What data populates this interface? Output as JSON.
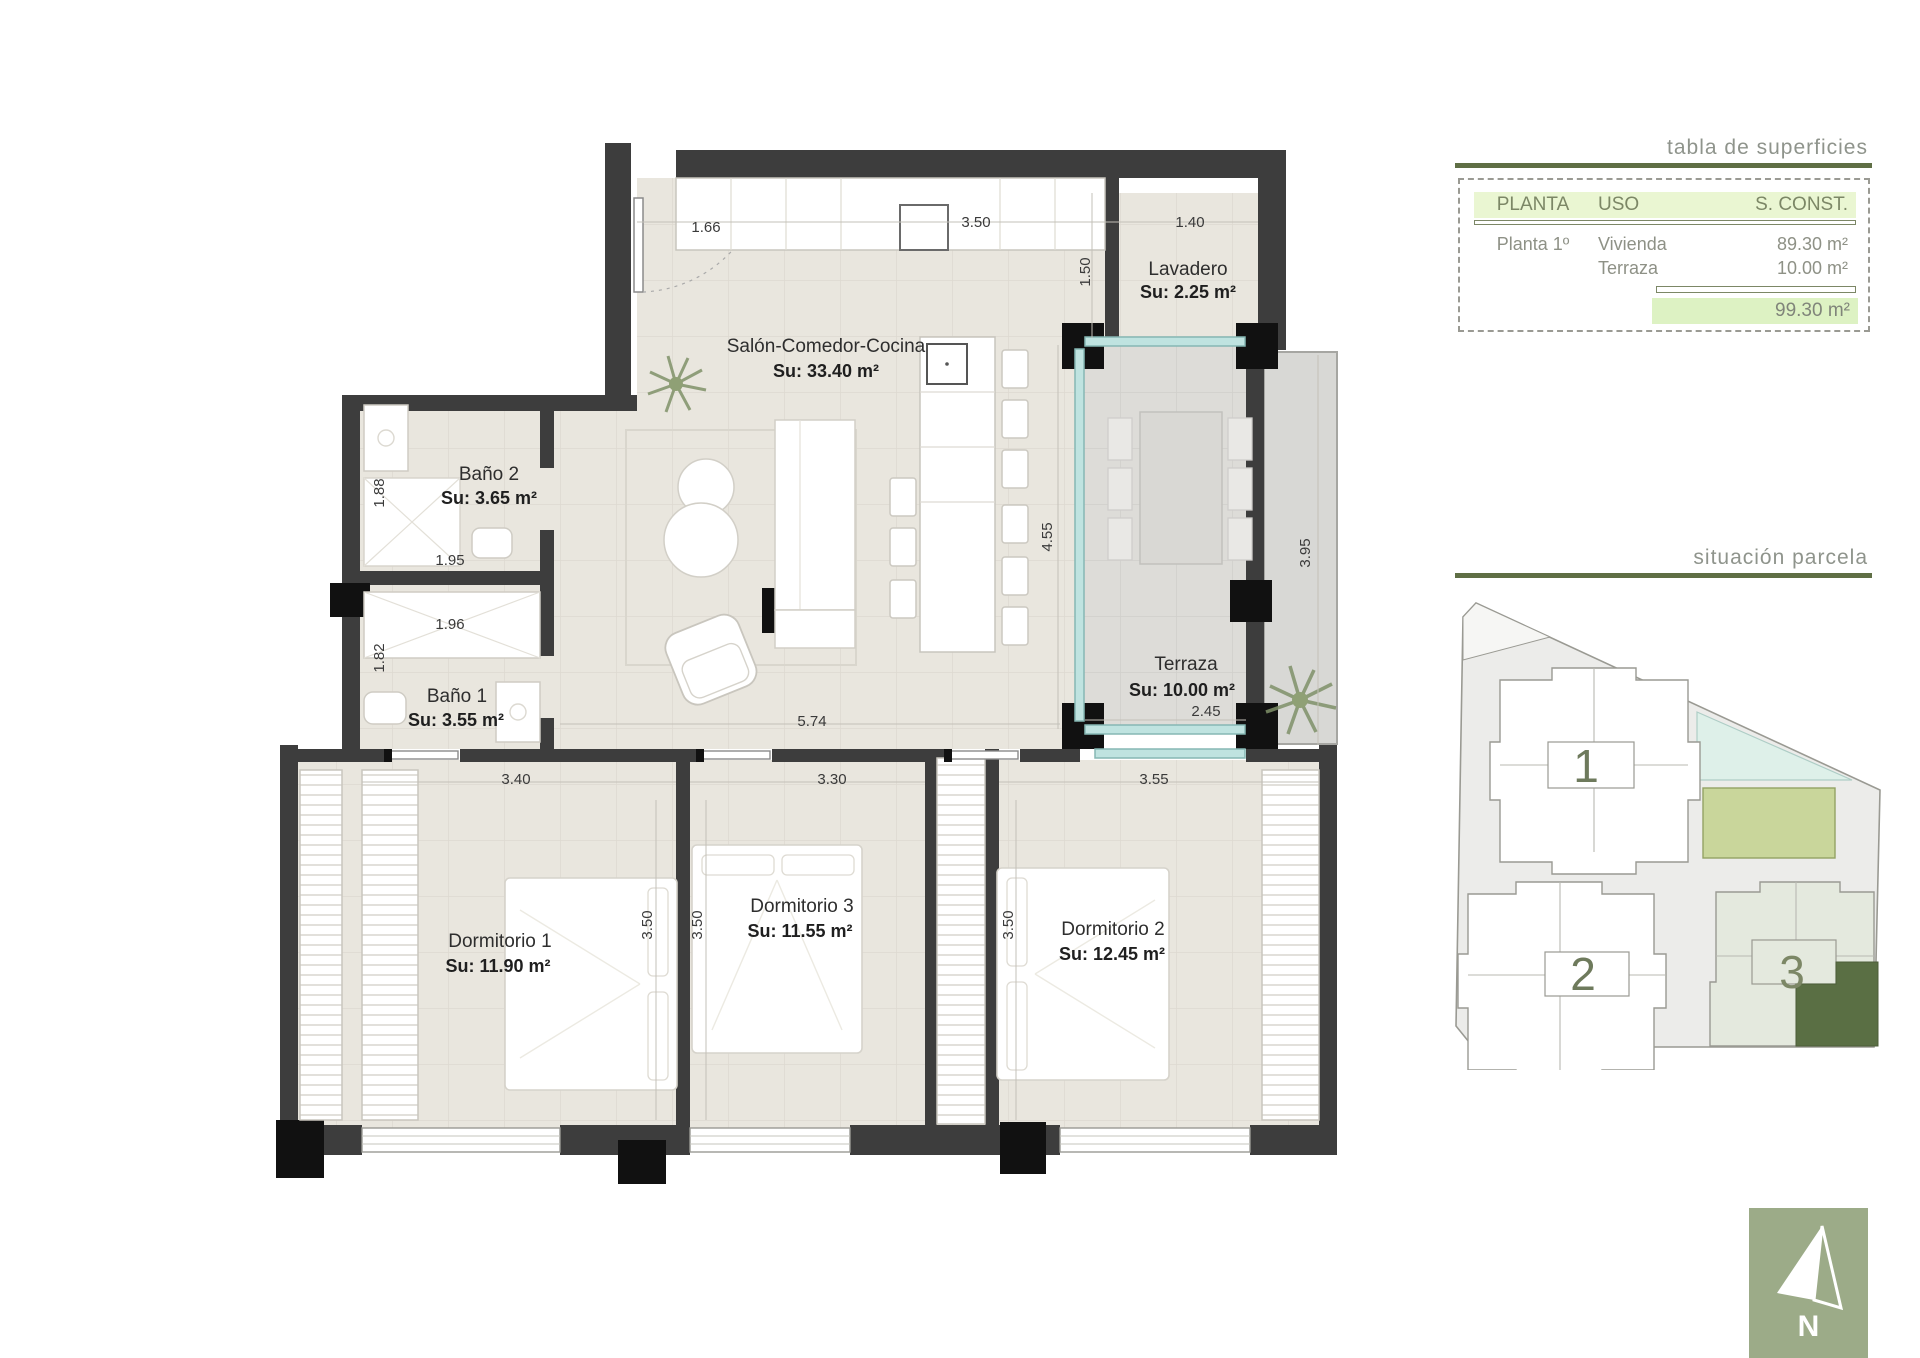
{
  "surface_table": {
    "title": "tabla de superficies",
    "columns": {
      "planta": "PLANTA",
      "uso": "USO",
      "sconst": "S. CONST."
    },
    "rows": [
      {
        "planta": "Planta 1º",
        "uso": "Vivienda",
        "value": "89.30 m²"
      },
      {
        "planta": "",
        "uso": "Terraza",
        "value": "10.00 m²"
      }
    ],
    "total": "99.30 m²"
  },
  "site": {
    "title": "situación parcela",
    "b1": "1",
    "b2": "2",
    "b3": "3"
  },
  "compass": {
    "label": "N"
  },
  "rooms": {
    "salon": {
      "name": "Salón-Comedor-Cocina",
      "area": "Su: 33.40 m²"
    },
    "lavadero": {
      "name": "Lavadero",
      "area": "Su: 2.25 m²"
    },
    "bano2": {
      "name": "Baño 2",
      "area": "Su: 3.65 m²"
    },
    "bano1": {
      "name": "Baño 1",
      "area": "Su: 3.55 m²"
    },
    "terraza": {
      "name": "Terraza",
      "area": "Su: 10.00 m²"
    },
    "dorm1": {
      "name": "Dormitorio 1",
      "area": "Su: 11.90 m²"
    },
    "dorm3": {
      "name": "Dormitorio 3",
      "area": "Su: 11.55 m²"
    },
    "dorm2": {
      "name": "Dormitorio 2",
      "area": "Su: 12.45 m²"
    }
  },
  "dims": {
    "entry": "1.66",
    "kitchen": "3.50",
    "lavadero_w": "1.40",
    "lavadero_h": "1.50",
    "bano2_h": "1.88",
    "bano2_w": "1.95",
    "bano1_w": "1.96",
    "bano1_h": "1.82",
    "salon_w": "5.74",
    "terraza_h": "4.55",
    "terraza_out": "3.95",
    "terraza_w": "2.45",
    "dorm1_w": "3.40",
    "dorm3_w": "3.30",
    "dorm2_w": "3.55",
    "dorm1_h": "3.50",
    "dorm3_h": "3.50",
    "dorm2_h": "3.50"
  },
  "colors": {
    "wall": "#3d3d3d",
    "floor": "#e9e6de",
    "accent_olive": "#5f6f45",
    "header_bg": "#eaf6d2",
    "total_bg": "#ddf2c3",
    "glass": "#bfe3e0",
    "highlight_unit": "#5a6f44",
    "compass_bg": "#9cab88",
    "pool": "#c9d69b"
  }
}
